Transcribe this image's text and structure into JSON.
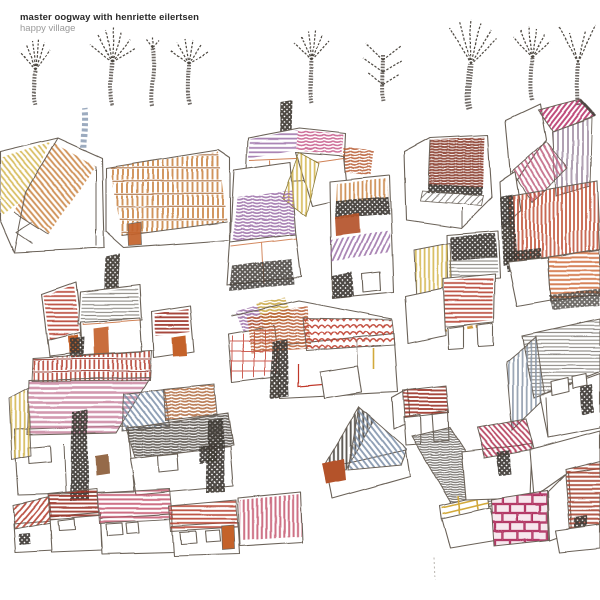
{
  "album": {
    "artist": "master oogway with henriette eilertsen",
    "title": "happy village"
  },
  "artwork": {
    "description": "child-like colored pencil drawing of a village: nine bare sketchy trees along the top, clusters of crooked houses with striped and scribbled roofs, chimneys, blue smoke, tree trunks and a pink brick wall on white paper",
    "palette": {
      "paper": "#ffffff",
      "pencil_outline": "#6b6259",
      "charcoal": "#3f3a35",
      "tan": "#c8803d",
      "yellow": "#d3b44a",
      "orange_door": "#c4622b",
      "red": "#b5402e",
      "dark_red": "#9c3326",
      "maroon": "#8a3c2c",
      "crimson": "#b03050",
      "pink": "#c4566e",
      "rose": "#c77f9b",
      "magenta": "#b8356b",
      "purple": "#9b6fa8",
      "mauve": "#a391a6",
      "blue": "#7d8fa8",
      "gray_pencil": "#6f6a64",
      "brown_door": "#8a5a35",
      "smoke_blue": "#8b9cb4"
    },
    "elements": [
      "bare trees",
      "striped roofs",
      "scribbled roofs",
      "chimney smoke",
      "orange doors",
      "brick wall",
      "tree trunks"
    ]
  }
}
